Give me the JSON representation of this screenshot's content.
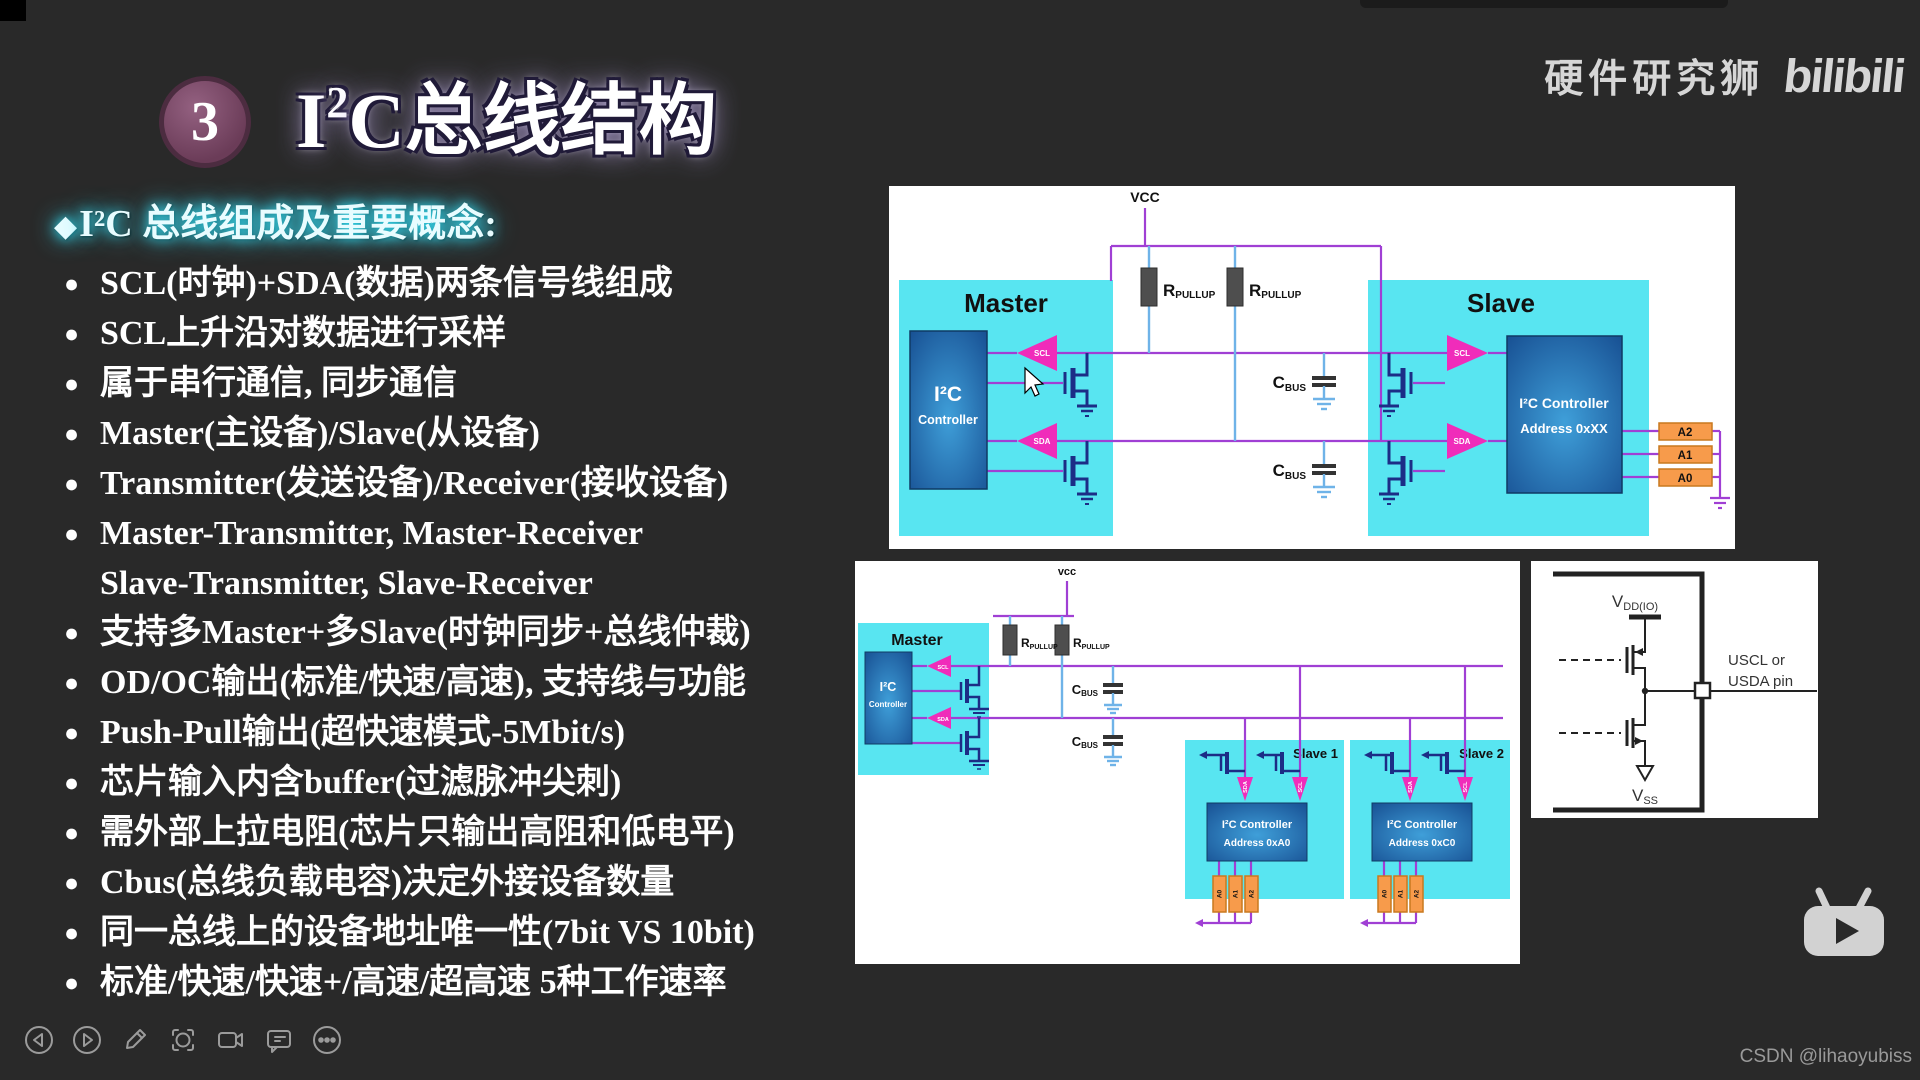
{
  "header": {
    "badge": "3",
    "title_pre": "I",
    "title_sup": "2",
    "title_post": "C总线结构",
    "brand": "硬件研究狮",
    "logo": "bilibili"
  },
  "list": {
    "marker": "◆",
    "heading": "I²C 总线组成及重要概念:",
    "items": [
      {
        "m": "●",
        "t": "SCL(时钟)+SDA(数据)两条信号线组成"
      },
      {
        "m": "●",
        "t": "SCL上升沿对数据进行采样"
      },
      {
        "m": "●",
        "t": "属于串行通信, 同步通信"
      },
      {
        "m": "●",
        "t": "Master(主设备)/Slave(从设备)"
      },
      {
        "m": "●",
        "t": "Transmitter(发送设备)/Receiver(接收设备)"
      },
      {
        "m": "●",
        "t": "Master-Transmitter, Master-Receiver"
      },
      {
        "m": "",
        "t": "Slave-Transmitter, Slave-Receiver"
      },
      {
        "m": "●",
        "t": "支持多Master+多Slave(时钟同步+总线仲裁)"
      },
      {
        "m": "●",
        "t": "OD/OC输出(标准/快速/高速), 支持线与功能"
      },
      {
        "m": "●",
        "t": "Push-Pull输出(超快速模式-5Mbit/s)"
      },
      {
        "m": "●",
        "t": "芯片输入内含buffer(过滤脉冲尖刺)"
      },
      {
        "m": "●",
        "t": "需外部上拉电阻(芯片只输出高阻和低电平)"
      },
      {
        "m": "●",
        "t": "Cbus(总线负载电容)决定外接设备数量"
      },
      {
        "m": "●",
        "t": "同一总线上的设备地址唯一性(7bit VS 10bit)"
      },
      {
        "m": "●",
        "t": "标准/快速/快速+/高速/超高速 5种工作速率"
      }
    ]
  },
  "d1": {
    "vcc": "VCC",
    "r": "R",
    "pullup": "PULLUP",
    "master": "Master",
    "slave": "Slave",
    "i2c": "I²C",
    "controller": "Controller",
    "scl": "SCL",
    "sda": "SDA",
    "c": "C",
    "bus": "BUS",
    "slave_ctrl": "I²C Controller",
    "slave_addr": "Address 0xXX",
    "a2": "A2",
    "a1": "A1",
    "a0": "A0"
  },
  "d2": {
    "vcc": "vcc",
    "r": "R",
    "pullup": "PULLUP",
    "master": "Master",
    "i2c": "I²C",
    "controller": "Controller",
    "scl": "SCL",
    "sda": "SDA",
    "c": "C",
    "bus": "BUS",
    "slave1": "Slave 1",
    "slave2": "Slave 2",
    "ctrl": "I²C Controller",
    "addr1": "Address 0xA0",
    "addr2": "Address 0xC0",
    "pins": [
      "A0",
      "A1",
      "A2"
    ]
  },
  "d3": {
    "v": "V",
    "dd": "DD(IO)",
    "ss": "SS",
    "pin1": "USCL or",
    "pin2": "USDA pin"
  },
  "colors": {
    "accent_cyan": "#58e5f1",
    "magenta": "#f02cba",
    "wire_purple": "#a03fd4",
    "wire_blue": "#6fb3e8",
    "orange": "#f79b4b",
    "badge_plum": "#6b3c58"
  },
  "footer": {
    "watermark": "CSDN @lihaoyubiss"
  }
}
